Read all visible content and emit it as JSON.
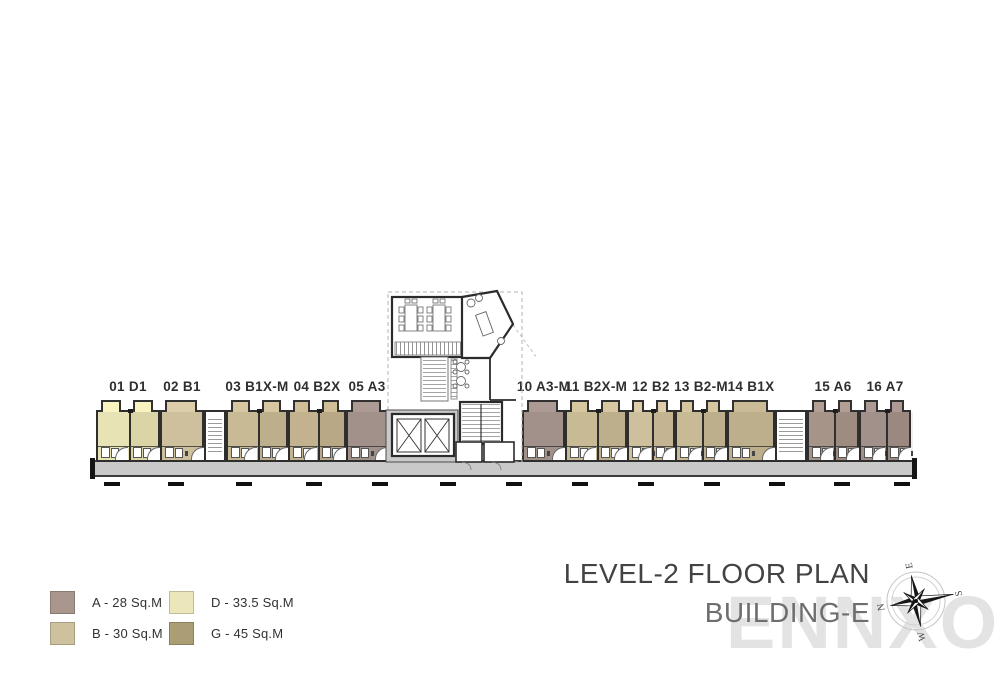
{
  "title": {
    "line1": "LEVEL-2 FLOOR PLAN",
    "line2": "BUILDING-E"
  },
  "watermark": {
    "text": "ENNXO"
  },
  "compass": {
    "north": "N",
    "east": "E",
    "south": "S",
    "west": "W"
  },
  "legend": {
    "items": [
      {
        "code": "A",
        "label": "A - 28 Sq.M",
        "color": "#a9968c"
      },
      {
        "code": "B",
        "label": "B - 30 Sq.M",
        "color": "#cec19e"
      },
      {
        "code": "D",
        "label": "D - 33.5 Sq.M",
        "color": "#ebe7ba"
      },
      {
        "code": "G",
        "label": "G - 45 Sq.M",
        "color": "#ab9e74"
      }
    ]
  },
  "floorplan": {
    "level": "2",
    "building": "E",
    "units": [
      {
        "id": "01",
        "label": "01 D1",
        "type": "D",
        "color": "#e8e3b4"
      },
      {
        "id": "02",
        "label": "02 B1",
        "type": "B",
        "color": "#cfc09d"
      },
      {
        "id": "03",
        "label": "03 B1X-M",
        "type": "B",
        "color": "#c9ba96"
      },
      {
        "id": "04",
        "label": "04 B2X",
        "type": "B",
        "color": "#c2b28e"
      },
      {
        "id": "05",
        "label": "05 A3",
        "type": "A",
        "color": "#a2908a"
      },
      {
        "id": "10",
        "label": "10 A3-M",
        "type": "A",
        "color": "#a2908a"
      },
      {
        "id": "11",
        "label": "11 B2X-M",
        "type": "B",
        "color": "#c9ba96"
      },
      {
        "id": "12",
        "label": "12 B2",
        "type": "B",
        "color": "#cfc09d"
      },
      {
        "id": "13",
        "label": "13 B2-M",
        "type": "B",
        "color": "#c9ba96"
      },
      {
        "id": "14",
        "label": "14 B1X",
        "type": "B",
        "color": "#bdae8c"
      },
      {
        "id": "15",
        "label": "15 A6",
        "type": "A",
        "color": "#a79489"
      },
      {
        "id": "16",
        "label": "16 A7",
        "type": "A",
        "color": "#a2908a"
      }
    ]
  }
}
